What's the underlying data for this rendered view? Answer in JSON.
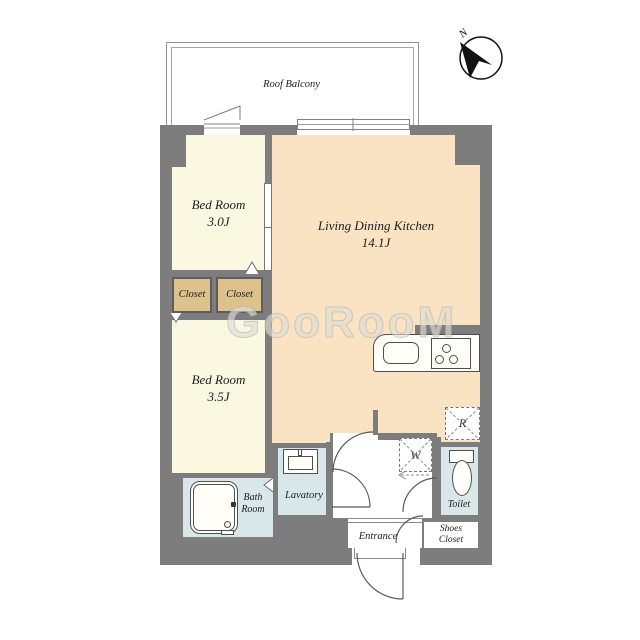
{
  "compass": {
    "label": "N"
  },
  "balcony": {
    "label": "Roof Balcony"
  },
  "rooms": {
    "bedroom1": {
      "name": "Bed Room",
      "size": "3.0J"
    },
    "ldk": {
      "name": "Living Dining Kitchen",
      "size": "14.1J"
    },
    "bedroom2": {
      "name": "Bed Room",
      "size": "3.5J"
    },
    "closet1": {
      "label": "Closet"
    },
    "closet2": {
      "label": "Closet"
    },
    "bath": {
      "line1": "Bath",
      "line2": "Room"
    },
    "lavatory": {
      "label": "Lavatory"
    },
    "toilet": {
      "label": "Toilet"
    },
    "entrance": {
      "label": "Entrance"
    },
    "shoes_closet": {
      "line1": "Shoes",
      "line2": "Closet"
    },
    "washer_space": {
      "label": "W"
    },
    "refrigerator_space": {
      "label": "R"
    }
  },
  "watermark": {
    "text": "GooRooM"
  },
  "colors": {
    "wall": "#7d7d7d",
    "bedroom_floor": "#fbf8e2",
    "ldk_floor": "#f9e3c3",
    "closet_fill": "#dec28e",
    "wet_area_fill": "#d8e7ea",
    "line": "#4f4f4f"
  }
}
